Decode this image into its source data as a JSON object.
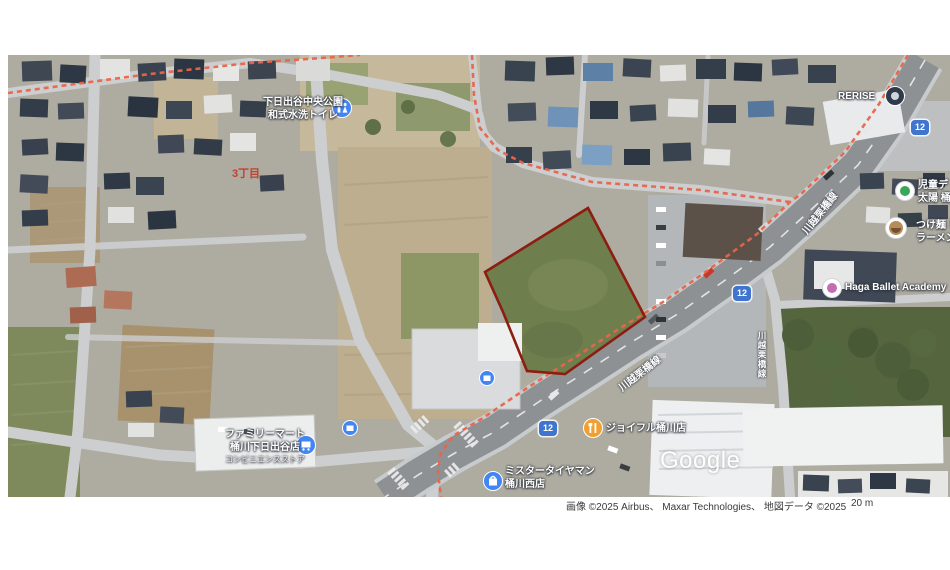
{
  "map": {
    "watermark": "Google",
    "route_shield_number": "12",
    "attribution_imagery": "画像 ©2025 Airbus、 Maxar Technologies、 地図データ ©2025",
    "scale_label": "20 m",
    "colors": {
      "parcel_outline": "#8c1d10",
      "route_overlay_orange": "#e8654a",
      "route_shield_blue": "#3f74cf",
      "poi_pin_blue": "#4285f4",
      "restaurant_pin_orange": "#f09f33",
      "district_label_red": "#c2402e"
    },
    "labels": {
      "park_name": "下日出谷中央公園",
      "park_sub": "和式水洗トイレ",
      "district": "3丁目",
      "rerise": "RERISE",
      "road_name": "川越栗橋線",
      "daycare_line1": "児童デ",
      "daycare_line2": "太陽 桶",
      "ramen_line1": "つけ麺 し",
      "ramen_line2": "ラーメン",
      "ballet": "Haga Ballet Academy",
      "joyfull": "ジョイフル桶川店",
      "tireman_line1": "ミスタータイヤマン",
      "tireman_line2": "桶川西店",
      "familymart_line1": "ファミリーマート",
      "familymart_line2": "桶川下日出谷店",
      "familymart_line3": "コンビニエンスストア"
    }
  }
}
